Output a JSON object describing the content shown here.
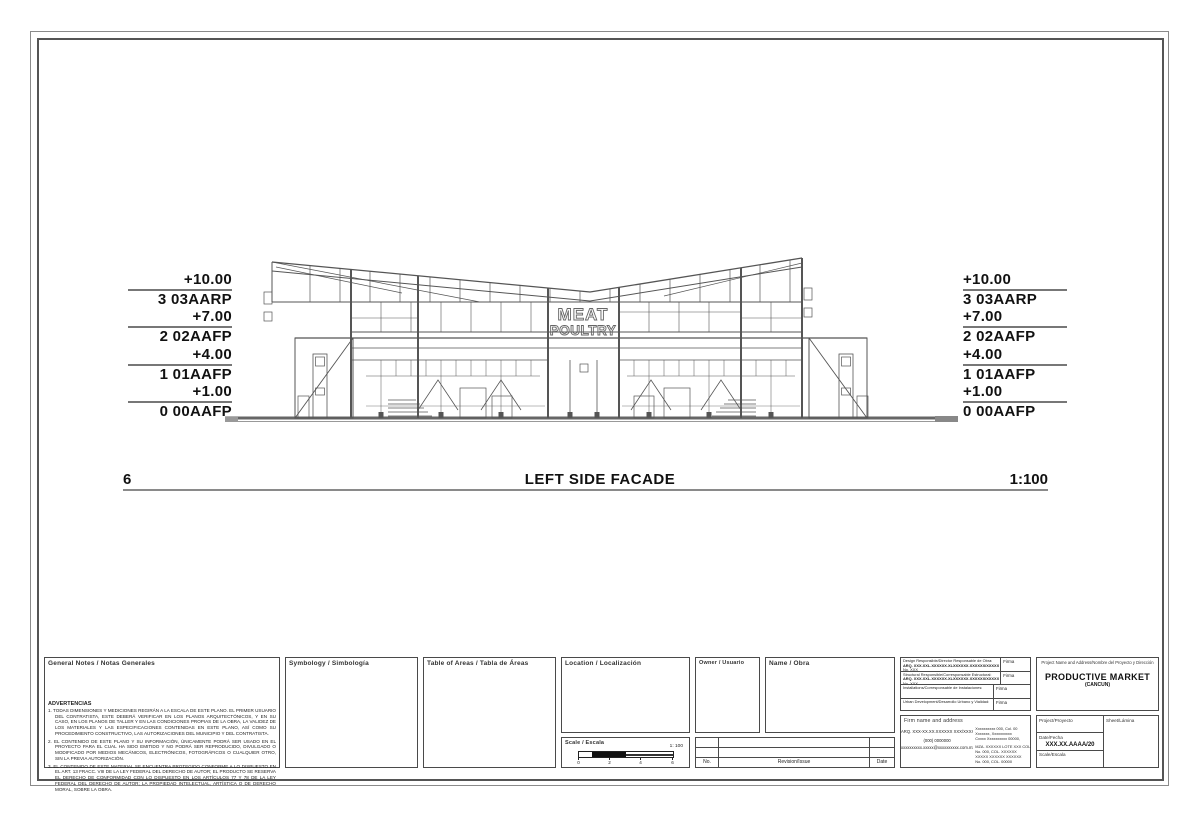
{
  "sheet": {
    "view_number": "6",
    "view_title": "LEFT SIDE FACADE",
    "view_scale": "1:100",
    "signage": {
      "line1": "MEAT",
      "line2": "POULTRY"
    },
    "levels": [
      {
        "elevation": "+10.00",
        "label": "3 03AARP"
      },
      {
        "elevation": "+7.00",
        "label": "2 02AAFP"
      },
      {
        "elevation": "+4.00",
        "label": "1 01AAFP"
      },
      {
        "elevation": "+1.00",
        "label": "0 00AAFP"
      }
    ]
  },
  "titleblock": {
    "general_notes": {
      "header": "General Notes / Notas Generales",
      "warning_header": "ADVERTENCIAS",
      "notes": [
        "1.  TODAS DIMENSIONES Y MEDICIONES REGIRÁN A LA ESCALA DE ESTE PLANO. EL PRIMER USUARIO DEL CONTRATISTA, ESTE DEBERÁ VERIFICAR EN LOS PLANOS ARQUITECTÓNICOS, Y EN SU CASO, EN LOS PLANOS DE TALLER Y EN LAS CONDICIONES PROPIAS DE LA OBRA, LA VALIDEZ DE LOS MATERIALES Y LAS ESPECIFICACIONES CONTENIDAS EN ESTE PLANO, ASÍ COMO SU PROCEDIMIENTO CONSTRUCTIVO, LAS AUTORIZACIONES DEL MUNICIPIO Y DEL CONTRATISTA.",
        "2.  EL CONTENIDO DE ESTE PLANO Y SU INFORMACIÓN, ÚNICAMENTE PODRÁ SER USADO EN EL PROYECTO PARA EL CUAL HA SIDO EMITIDO Y NO PODRÁ SER REPRODUCIDO, DIVULGADO O MODIFICADO POR MEDIOS MECÁNICOS, ELECTRÓNICOS, FOTOGRÁFICOS O CUALQUIER OTRO, SIN LA PREVIA AUTORIZACIÓN.",
        "3.  EL CONTENIDO DE ESTE MATERIAL SE ENCUENTRA PROTEGIDO CONFORME A LO DISPUESTO EN EL ART. 13 FRACC. VIII DE LA LEY FEDERAL DEL DERECHO DE AUTOR; EL PRODUCTO SE RESERVA EL DERECHO DE CONFORMIDAD CON LO DISPUESTO EN LOS ARTÍCULOS 77 Y 78  DE LA LEY FEDERAL DEL DERECHO DE AUTOR; LA PROPIEDAD INTELECTUAL, ARTÍSTICA O DE DERECHO MORAL, SOBRE LA OBRA."
      ]
    },
    "symbology": {
      "header": "Symbology / Simbología"
    },
    "areas": {
      "header": "Table of Areas / Tabla de Áreas"
    },
    "location": {
      "header": "Location / Localización"
    },
    "owner": {
      "header": "Owner / Usuario"
    },
    "name": {
      "header": "Name / Obra"
    },
    "scale_box": {
      "header": "Scale / Escala",
      "ratio": "1: 100",
      "ticks": [
        "0",
        "2",
        "4",
        "6"
      ]
    },
    "revision_table": {
      "col_no": "No.",
      "col_revision": "Revision/Issue",
      "col_date": "Date"
    },
    "signatures": {
      "rows": [
        {
          "line1": "Design Responsible/Director Responsable de Obra:",
          "line2": "ARQ. XXX.XXL.XXXXXX.XLXXXXXX.XXXXXX/XXXXX",
          "line3": "No. XXX",
          "sign": "Firma"
        },
        {
          "line1": "Structural Responsible/Corresponsable Estructural:",
          "line2": "ARQ. XXX.XXL.XXXXXX.XLXXXXXX.XXXXXX/XXXXX",
          "line3": "No. XXX",
          "sign": "Firma"
        },
        {
          "line1": "Installations/Corresponsable de Instalaciones:",
          "line2": "",
          "line3": "",
          "sign": "Firma"
        },
        {
          "line1": "Urban Development/Desarrollo Urbano y Vialidad:",
          "line2": "",
          "line3": "",
          "sign": "Firma"
        }
      ]
    },
    "firm": {
      "header": "Firm name and address",
      "name": "ARQ. XXX-XX.XX.XXXXXX XXX/XXXXX",
      "phone": "(000) 0000000",
      "email": "xxxxxxxxxx.xxxxx@xxxxxxxxxx.com.mx",
      "address_lines": [
        "Xxxxxxxxxx 000, Col. 00",
        "Xxxxxxx, Xxxxxxxxxx",
        "Cxxxx Xxxxxxxxxx 00000,",
        "MZA. XXXXXX LOTE XXX COL.",
        "No. 000, COL. XXXXXX",
        "XXXXX XXXXXX XXXXXX",
        "No. 000, COL. 00000"
      ]
    },
    "project": {
      "header": "Project Name and Address/Nombre del Proyecto y Dirección",
      "name": "PRODUCTIVE MARKET",
      "subname": "(CANCUN)",
      "project_label": "Project/Proyecto",
      "date_label": "Date/Fecha",
      "date_value": "XXX.XX.AAAA/20",
      "scale_label": "Scale/Escala",
      "sheet_label": "Sheet/Lámina"
    }
  }
}
